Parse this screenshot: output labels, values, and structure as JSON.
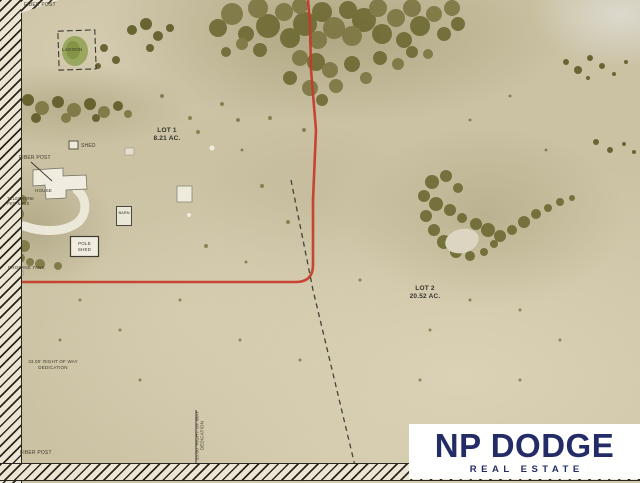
{
  "map": {
    "fiber_post_top": "FIBER POST",
    "fiber_post_mid": "FIBER POST",
    "fiber_post_bottom": "FIBER POST",
    "lagoon_label": "LAGOON",
    "lot1_name": "LOT 1",
    "lot1_area": "8.21 AC.",
    "lot2_name": "LOT 2",
    "lot2_area": "20.52 AC.",
    "shed_label": "SHED",
    "house_label": "HOUSE",
    "telephone_label": "TELEPHONE PED & RIS",
    "barn_label": "BARN",
    "pole_shed_line1": "POLE",
    "pole_shed_line2": "SHED",
    "propane_label": "PROPANE TANK",
    "row_line1": "33.00' RIGHT OF WAY",
    "row_line2": "DEDICATION",
    "row_vertical_line1": "33.00' RIGHT OF WAY",
    "row_vertical_line2": "DEDICATION"
  },
  "logo": {
    "brand": "NP DODGE",
    "tagline": "REAL ESTATE",
    "navy": "#232c66"
  },
  "colors": {
    "boundary_red": "#c43a28",
    "ground_tan": "#cbc2a4",
    "tree_olive": "#6e6a33"
  }
}
